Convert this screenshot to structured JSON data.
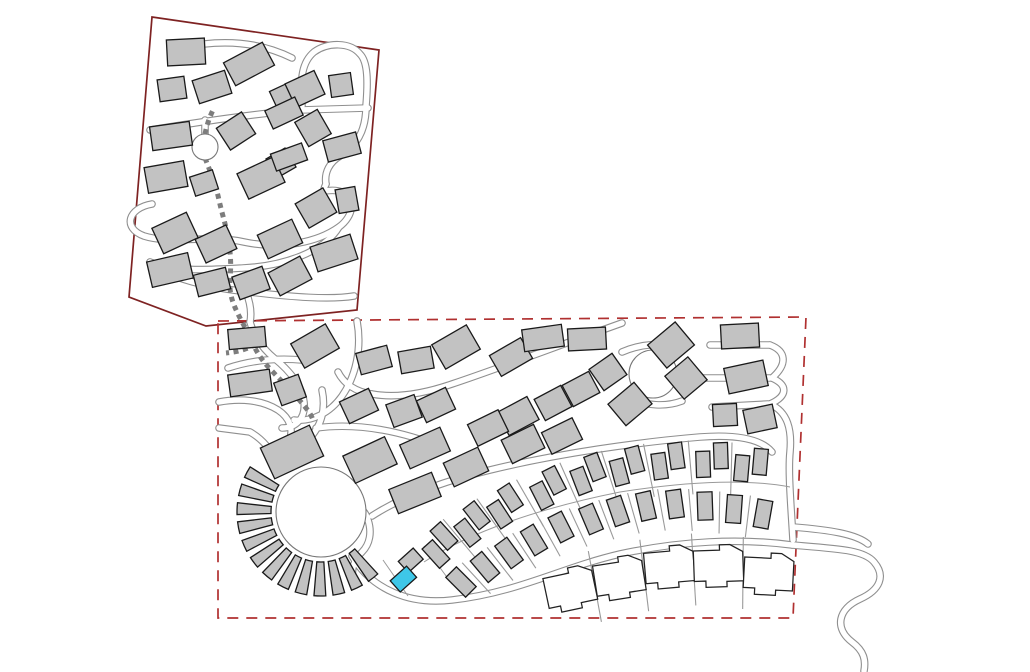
{
  "map": {
    "kind": "residential-development-site-plan",
    "canvas": {
      "width": 1030,
      "height": 672
    },
    "colors": {
      "background": "#ffffff",
      "building_fill": "#c2c2c2",
      "building_stroke": "#1a1a1a",
      "road_casing": "#8f8f8f",
      "road_fill": "#ffffff",
      "footpath": "#7d7d7d",
      "boundary_upper": "#7e2222",
      "boundary_lower": "#b03030",
      "highlight_fill": "#3ec7e8",
      "lot_line": "#9a9a9a",
      "circle_stroke": "#777777",
      "white_house_fill": "#ffffff",
      "white_house_stroke": "#222222"
    },
    "stroke": {
      "road_casing_w": 7.6,
      "road_fill_w": 5.4,
      "boundary_w": 1.7,
      "building_w": 1.3,
      "footpath_w": 5,
      "footpath_dash": "5 4.5",
      "boundary_dash": "11 8",
      "lot_line_w": 1.1,
      "thin_w": 1
    },
    "parcels": {
      "upper": {
        "points": "152,17 379,50 357,310 206,326 129,297",
        "style": "solid"
      },
      "lower": {
        "points": "218,321 806,317 793,618 218,618",
        "style": "dashed"
      }
    },
    "roads": [
      "M 204 44 C 240 40 268 46 292 58",
      "M 150 130 C 200 122 252 114 300 110 L 368 108",
      "M 302 106 C 300 78 302 62 314 52 C 328 42 350 42 360 54 C 368 62 368 82 366 106",
      "M 366 106 C 366 132 356 146 340 156 C 330 162 324 172 326 184",
      "M 205 134 L 205 120",
      "M 152 204 C 128 208 122 228 144 236 C 172 245 208 234 244 242 C 282 250 318 242 339 227 C 354 216 356 198 342 192 C 330 187 320 196 326 184",
      "M 339 227 C 324 252 284 266 243 268 C 206 270 176 272 150 262",
      "M 150 262 C 168 278 208 288 250 292 C 292 297 330 300 354 296",
      "M 246 292 C 250 302 252 312 250 322",
      "M 250 322 C 254 336 262 348 274 358 C 290 371 302 386 304 402 C 306 418 296 428 282 428",
      "M 357 321 C 362 348 356 376 342 396 C 330 413 312 422 294 420",
      "M 228 368 C 252 360 278 358 302 360",
      "M 219 428 L 250 432",
      "M 250 432 C 264 440 272 452 276 462",
      "M 219 402 C 240 398 262 400 278 410 C 290 418 294 430 289 441",
      "M 322 390 C 326 408 322 426 308 440 C 296 452 284 458 276 462",
      "M 316 428 C 360 422 404 432 444 448",
      "M 622 323 C 560 345 500 368 452 384 C 420 395 394 398 372 394",
      "M 372 394 C 356 392 344 384 338 372",
      "M 372 516 C 400 498 440 482 490 470 C 560 453 640 442 700 437 C 740 434 762 440 772 452",
      "M 622 352 C 640 344 662 342 680 348",
      "M 630 398 C 646 406 666 407 682 401",
      "M 710 345 L 770 345",
      "M 700 378 L 770 378",
      "M 712 407 L 768 404",
      "M 770 345 C 786 351 788 364 772 378",
      "M 772 378 C 788 385 788 396 770 404",
      "M 770 404 C 788 412 792 430 790 452 C 788 472 791 505 793 540",
      "M 346 498 C 360 506 366 512 368 520 C 372 532 370 544 362 552 C 354 560 350 570 354 582",
      "M 352 556 C 372 590 410 605 452 600 C 520 592 560 568 620 554 C 680 541 740 538 792 545",
      "M 793 527 C 830 530 856 534 868 544",
      "M 792 545 C 840 549 864 550 874 562 C 886 576 880 590 860 599 C 838 609 834 628 852 642 C 864 651 866 660 864 671"
    ],
    "footpaths": [
      "M 205 158 C 212 176 216 186 219 200 C 223 218 227 228 229 244 C 231 258 231 266 230 280 C 229 294 233 304 239 316 C 244 326 249 334 253 344 C 258 355 265 364 273 372 C 283 383 293 392 301 402 C 307 409 311 414 313 420",
      "M 256 344 C 246 350 236 352 226 353",
      "M 205 134 C 207 124 210 116 214 108"
    ],
    "circles": [
      {
        "cx": 205,
        "cy": 147,
        "r": 13,
        "name": "mini-roundabout"
      },
      {
        "cx": 653,
        "cy": 374,
        "r": 24,
        "name": "east-roundabout"
      },
      {
        "cx": 321,
        "cy": 512,
        "r": 45,
        "name": "central-plaza"
      }
    ],
    "ring": {
      "cx": 321,
      "cy": 512,
      "ri": 50,
      "ro": 84,
      "a0": 45,
      "a1": 215,
      "n": 13,
      "gap": 2.5
    },
    "buildings_upper": [
      [
        186,
        52,
        38,
        26,
        -3
      ],
      [
        249,
        64,
        44,
        26,
        -28
      ],
      [
        172,
        89,
        27,
        22,
        -8
      ],
      [
        212,
        87,
        34,
        24,
        -18
      ],
      [
        281,
        95,
        18,
        16,
        -25
      ],
      [
        305,
        89,
        32,
        26,
        -25
      ],
      [
        341,
        85,
        22,
        22,
        -8
      ],
      [
        171,
        136,
        40,
        24,
        -8
      ],
      [
        236,
        131,
        30,
        26,
        -33
      ],
      [
        284,
        113,
        33,
        20,
        -25
      ],
      [
        313,
        128,
        26,
        28,
        -30
      ],
      [
        342,
        147,
        34,
        22,
        -15
      ],
      [
        281,
        163,
        22,
        22,
        -30
      ],
      [
        166,
        177,
        40,
        26,
        -10
      ],
      [
        204,
        183,
        24,
        20,
        -18
      ],
      [
        261,
        178,
        40,
        28,
        -25
      ],
      [
        289,
        157,
        33,
        18,
        -20
      ],
      [
        316,
        208,
        32,
        28,
        -30
      ],
      [
        347,
        200,
        20,
        24,
        -10
      ],
      [
        280,
        239,
        38,
        26,
        -25
      ],
      [
        334,
        253,
        42,
        26,
        -18
      ],
      [
        175,
        233,
        38,
        28,
        -25
      ],
      [
        216,
        244,
        34,
        26,
        -25
      ],
      [
        170,
        270,
        42,
        26,
        -13
      ],
      [
        212,
        282,
        33,
        22,
        -14
      ],
      [
        251,
        283,
        32,
        24,
        -20
      ],
      [
        290,
        276,
        36,
        26,
        -28
      ]
    ],
    "buildings_lower": [
      [
        247,
        338,
        37,
        20,
        -5
      ],
      [
        315,
        346,
        40,
        28,
        -30
      ],
      [
        374,
        360,
        32,
        22,
        -15
      ],
      [
        416,
        360,
        33,
        22,
        -10
      ],
      [
        456,
        347,
        40,
        28,
        -30
      ],
      [
        511,
        357,
        36,
        24,
        -30
      ],
      [
        543,
        338,
        40,
        22,
        -8
      ],
      [
        587,
        339,
        38,
        22,
        -3
      ],
      [
        671,
        345,
        36,
        30,
        -40
      ],
      [
        740,
        336,
        38,
        24,
        -3
      ],
      [
        250,
        383,
        42,
        22,
        -8
      ],
      [
        290,
        390,
        26,
        24,
        -20
      ],
      [
        359,
        406,
        32,
        24,
        -25
      ],
      [
        404,
        411,
        30,
        24,
        -20
      ],
      [
        436,
        405,
        32,
        24,
        -25
      ],
      [
        518,
        416,
        34,
        26,
        -28
      ],
      [
        553,
        403,
        30,
        24,
        -28
      ],
      [
        581,
        389,
        30,
        24,
        -28
      ],
      [
        608,
        372,
        28,
        26,
        -35
      ],
      [
        686,
        378,
        30,
        30,
        -40
      ],
      [
        746,
        377,
        40,
        26,
        -12
      ],
      [
        630,
        404,
        34,
        28,
        -40
      ],
      [
        725,
        415,
        24,
        22,
        -3
      ],
      [
        760,
        419,
        30,
        24,
        -12
      ],
      [
        292,
        452,
        54,
        34,
        -25
      ],
      [
        370,
        460,
        46,
        30,
        -25
      ],
      [
        425,
        448,
        44,
        26,
        -24
      ],
      [
        415,
        493,
        46,
        26,
        -22
      ],
      [
        466,
        467,
        38,
        26,
        -25
      ],
      [
        488,
        428,
        34,
        24,
        -26
      ],
      [
        523,
        444,
        36,
        26,
        -26
      ],
      [
        562,
        436,
        34,
        24,
        -26
      ]
    ],
    "pair_row": {
      "unit_w": 14,
      "unit_h": 26,
      "off_x": 9,
      "off_y": 4,
      "items": [
        [
          440,
          545,
          -42
        ],
        [
          472,
          524,
          -38
        ],
        [
          505,
          506,
          -33
        ],
        [
          548,
          488,
          -27
        ],
        [
          588,
          474,
          -21
        ],
        [
          627,
          466,
          -15
        ],
        [
          668,
          461,
          -8
        ],
        [
          712,
          460,
          -2
        ],
        [
          751,
          465,
          5
        ]
      ]
    },
    "single_row": {
      "unit_w": 15,
      "unit_h": 28,
      "items": [
        [
          461,
          582,
          -45
        ],
        [
          485,
          567,
          -40
        ],
        [
          509,
          553,
          -36
        ],
        [
          534,
          540,
          -31
        ],
        [
          561,
          527,
          -27
        ],
        [
          591,
          519,
          -23
        ],
        [
          618,
          511,
          -19
        ],
        [
          646,
          506,
          -13
        ],
        [
          675,
          504,
          -8
        ],
        [
          705,
          506,
          -2
        ],
        [
          734,
          509,
          4
        ],
        [
          763,
          514,
          10
        ]
      ]
    },
    "white_houses": {
      "outline": "M -23 -16 L 2 -16 L 2 -21 L 12 -21 L 24 -14 L 24 14 L 8 14 L 8 19 L -12 19 L -12 13 L -23 13 Z",
      "items": [
        [
          570,
          590,
          -12
        ],
        [
          619,
          579,
          -9
        ],
        [
          669,
          568,
          -5
        ],
        [
          718,
          567,
          -2
        ],
        [
          768,
          575,
          3
        ]
      ]
    },
    "highlight_pair": {
      "cx": 406,
      "cy": 570,
      "rot": -42,
      "selected": {
        "dx": -8,
        "dy": 5,
        "w": 22,
        "h": 15,
        "status": "selected-lot"
      },
      "partner": {
        "dx": 10,
        "dy": -4,
        "w": 20,
        "h": 15
      }
    },
    "thin_lines": [
      "M 424 562 C 470 532 540 508 620 492 C 690 481 748 479 790 487",
      "M 383 560 L 408 596",
      "M 424 546 L 452 584"
    ],
    "lot_line_rows": [
      {
        "row": "pair_row",
        "before": 20,
        "after": 34
      },
      {
        "row": "single_row",
        "before": 16,
        "after": 26
      },
      {
        "row": "white_houses",
        "before": 34,
        "after": 38
      }
    ]
  }
}
